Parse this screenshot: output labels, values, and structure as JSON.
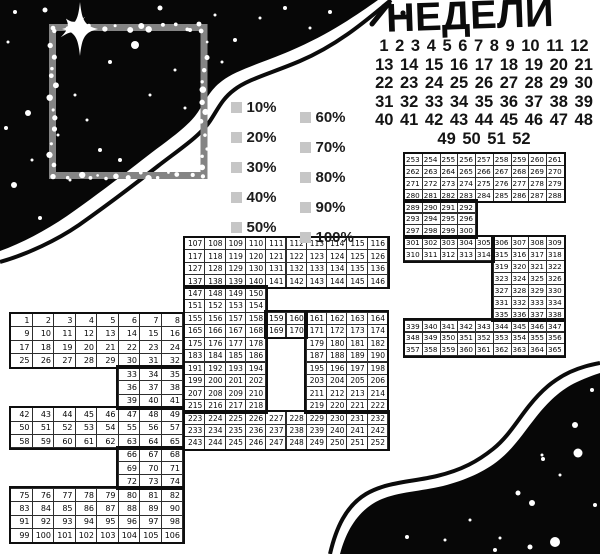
{
  "title": {
    "text": "НЕДЕЛИ"
  },
  "week_numbers": {
    "rows": [
      "1 2 3 4 5 6 7 8 9 10 11 12",
      "13 14 15 16 17 18 19 20 21",
      "22 23 24 25 26 27 28 29 30",
      "31 32 33 34 35 36 37 38 39",
      "40 41 42 43 44 45 46 47 48",
      "49 50 51 52"
    ]
  },
  "legend": {
    "swatch_color": "#c6c6c6",
    "columns": [
      [
        "10%",
        "20%",
        "30%",
        "40%",
        "50%"
      ],
      [
        "60%",
        "70%",
        "80%",
        "90%",
        "100%"
      ]
    ]
  },
  "colors": {
    "ink": "#0e0e0e",
    "frame_gray": "#848484",
    "sky_black": "#070707"
  },
  "grids": [
    {
      "name": "digit-3",
      "cols": 8,
      "rows": [
        [
          {
            "c": 1,
            "v": [
              1,
              2,
              3,
              4,
              5,
              6,
              7,
              8
            ]
          }
        ],
        [
          {
            "c": 1,
            "v": [
              9,
              10,
              11,
              12,
              13,
              14,
              15,
              16
            ]
          }
        ],
        [
          {
            "c": 1,
            "v": [
              17,
              18,
              19,
              20,
              21,
              22,
              23,
              24
            ]
          }
        ],
        [
          {
            "c": 1,
            "v": [
              25,
              26,
              27,
              28,
              29,
              30,
              31,
              32
            ]
          }
        ],
        [
          {
            "c": 6,
            "v": [
              33,
              34,
              35
            ]
          }
        ],
        [
          {
            "c": 6,
            "v": [
              36,
              37,
              38
            ]
          }
        ],
        [
          {
            "c": 6,
            "v": [
              39,
              40,
              41
            ]
          }
        ],
        [
          {
            "c": 1,
            "v": [
              42,
              43,
              44,
              45,
              46,
              47,
              48,
              49
            ]
          }
        ],
        [
          {
            "c": 1,
            "v": [
              50,
              51,
              52,
              53,
              54,
              55,
              56,
              57
            ]
          }
        ],
        [
          {
            "c": 1,
            "v": [
              58,
              59,
              60,
              61,
              62,
              63,
              64,
              65
            ]
          }
        ],
        [
          {
            "c": 6,
            "v": [
              66,
              67,
              68
            ]
          }
        ],
        [
          {
            "c": 6,
            "v": [
              69,
              70,
              71
            ]
          }
        ],
        [
          {
            "c": 6,
            "v": [
              72,
              73,
              74
            ]
          }
        ],
        [
          {
            "c": 1,
            "v": [
              75,
              76,
              77,
              78,
              79,
              80,
              81,
              82
            ]
          }
        ],
        [
          {
            "c": 1,
            "v": [
              83,
              84,
              85,
              86,
              87,
              88,
              89,
              90
            ]
          }
        ],
        [
          {
            "c": 1,
            "v": [
              91,
              92,
              93,
              94,
              95,
              96,
              97,
              98
            ]
          }
        ],
        [
          {
            "c": 1,
            "v": [
              99,
              100,
              101,
              102,
              103,
              104,
              105,
              106
            ]
          }
        ]
      ]
    },
    {
      "name": "digit-6",
      "cols": 10,
      "rows": [
        [
          {
            "c": 1,
            "v": [
              107,
              108,
              109,
              110,
              111,
              112,
              113,
              114,
              115,
              116
            ]
          }
        ],
        [
          {
            "c": 1,
            "v": [
              117,
              118,
              119,
              120,
              121,
              122,
              123,
              124,
              125,
              126
            ]
          }
        ],
        [
          {
            "c": 1,
            "v": [
              127,
              128,
              129,
              130,
              131,
              132,
              133,
              134,
              135,
              136
            ]
          }
        ],
        [
          {
            "c": 1,
            "v": [
              137,
              138,
              139,
              140,
              141,
              142,
              143,
              144,
              145,
              146
            ]
          }
        ],
        [
          {
            "c": 1,
            "v": [
              147,
              148,
              149,
              150
            ]
          }
        ],
        [
          {
            "c": 1,
            "v": [
              151,
              152,
              153,
              154
            ]
          }
        ],
        [
          {
            "c": 1,
            "v": [
              155,
              156,
              157,
              158,
              159,
              160,
              161,
              162,
              163,
              164
            ]
          }
        ],
        [
          {
            "c": 1,
            "v": [
              165,
              166,
              167,
              168,
              169,
              170,
              171,
              172,
              173,
              174
            ]
          }
        ],
        [
          {
            "c": 1,
            "v": [
              175,
              176,
              177,
              178
            ]
          },
          {
            "c": 7,
            "v": [
              179,
              180,
              181,
              182
            ]
          }
        ],
        [
          {
            "c": 1,
            "v": [
              183,
              184,
              185,
              186
            ]
          },
          {
            "c": 7,
            "v": [
              187,
              188,
              189,
              190
            ]
          }
        ],
        [
          {
            "c": 1,
            "v": [
              191,
              192,
              193,
              194
            ]
          },
          {
            "c": 7,
            "v": [
              195,
              196,
              197,
              198
            ]
          }
        ],
        [
          {
            "c": 1,
            "v": [
              199,
              200,
              201,
              202
            ]
          },
          {
            "c": 7,
            "v": [
              203,
              204,
              205,
              206
            ]
          }
        ],
        [
          {
            "c": 1,
            "v": [
              207,
              208,
              209,
              210
            ]
          },
          {
            "c": 7,
            "v": [
              211,
              212,
              213,
              214
            ]
          }
        ],
        [
          {
            "c": 1,
            "v": [
              215,
              216,
              217,
              218
            ]
          },
          {
            "c": 7,
            "v": [
              219,
              220,
              221,
              222
            ]
          }
        ],
        [
          {
            "c": 1,
            "v": [
              223,
              224,
              225,
              226,
              227,
              228,
              229,
              230,
              231,
              232
            ]
          }
        ],
        [
          {
            "c": 1,
            "v": [
              233,
              234,
              235,
              236,
              237,
              238,
              239,
              240,
              241,
              242
            ]
          }
        ],
        [
          {
            "c": 1,
            "v": [
              243,
              244,
              245,
              246,
              247,
              248,
              249,
              250,
              251,
              252
            ]
          }
        ]
      ]
    },
    {
      "name": "digit-5",
      "cols": 9,
      "rows": [
        [
          {
            "c": 1,
            "v": [
              253,
              254,
              255,
              256,
              257,
              258,
              259,
              260,
              261
            ]
          }
        ],
        [
          {
            "c": 1,
            "v": [
              262,
              263,
              264,
              265,
              266,
              267,
              268,
              269,
              270
            ]
          }
        ],
        [
          {
            "c": 1,
            "v": [
              271,
              272,
              273,
              274,
              275,
              276,
              277,
              278,
              279
            ]
          }
        ],
        [
          {
            "c": 1,
            "v": [
              280,
              281,
              282,
              283,
              284,
              285,
              286,
              287,
              288
            ]
          }
        ],
        [
          {
            "c": 1,
            "v": [
              289,
              290,
              291,
              292
            ]
          }
        ],
        [
          {
            "c": 1,
            "v": [
              293,
              294,
              295,
              296
            ]
          }
        ],
        [
          {
            "c": 1,
            "v": [
              297,
              298,
              299,
              300
            ]
          }
        ],
        [
          {
            "c": 1,
            "v": [
              301,
              302,
              303,
              304,
              305,
              306,
              307,
              308,
              309
            ]
          }
        ],
        [
          {
            "c": 1,
            "v": [
              310,
              311,
              312,
              313,
              314,
              315,
              316,
              317,
              318
            ]
          }
        ],
        [
          {
            "c": 6,
            "v": [
              319,
              320,
              321,
              322
            ]
          }
        ],
        [
          {
            "c": 6,
            "v": [
              323,
              324,
              325,
              326
            ]
          }
        ],
        [
          {
            "c": 6,
            "v": [
              327,
              328,
              329,
              330
            ]
          }
        ],
        [
          {
            "c": 6,
            "v": [
              331,
              332,
              333,
              334
            ]
          }
        ],
        [
          {
            "c": 6,
            "v": [
              335,
              336,
              337,
              338
            ]
          }
        ],
        [
          {
            "c": 1,
            "v": [
              339,
              340,
              341,
              342,
              343,
              344,
              345,
              346,
              347
            ]
          }
        ],
        [
          {
            "c": 1,
            "v": [
              348,
              349,
              350,
              351,
              352,
              353,
              354,
              355,
              356
            ]
          }
        ],
        [
          {
            "c": 1,
            "v": [
              357,
              358,
              359,
              360,
              361,
              362,
              363,
              364,
              365
            ]
          }
        ]
      ]
    }
  ]
}
